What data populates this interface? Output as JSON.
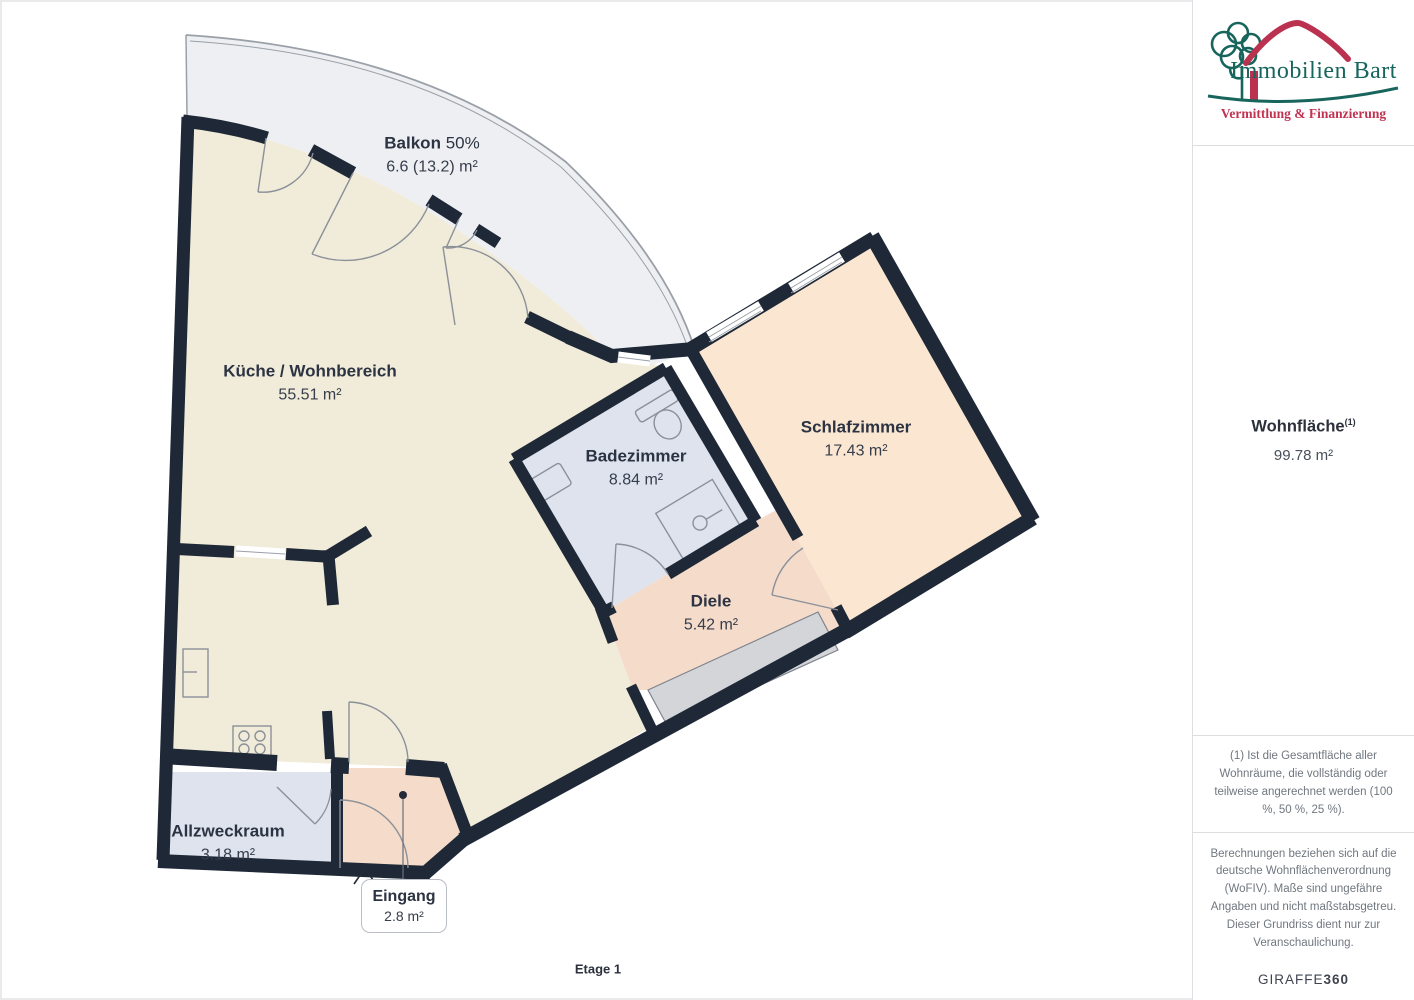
{
  "plan": {
    "floor_label": "Etage 1",
    "rooms": [
      {
        "id": "balkon",
        "name": "Balkon",
        "name_suffix": "50%",
        "area": "6.6 (13.2) m²"
      },
      {
        "id": "kueche",
        "name": "Küche / Wohnbereich",
        "area": "55.51 m²"
      },
      {
        "id": "badezimmer",
        "name": "Badezimmer",
        "area": "8.84 m²"
      },
      {
        "id": "schlafzimmer",
        "name": "Schlafzimmer",
        "area": "17.43 m²"
      },
      {
        "id": "diele",
        "name": "Diele",
        "area": "5.42 m²"
      },
      {
        "id": "allzweckraum",
        "name": "Allzweckraum",
        "area": "3.18 m²"
      },
      {
        "id": "eingang",
        "name": "Eingang",
        "area": "2.8 m²"
      }
    ],
    "colors": {
      "wall": "#1e2836",
      "kueche": "#f1ecd9",
      "balkon": "#edeff3",
      "badezimmer": "#dee3ee",
      "schlafzimmer": "#fbe7d1",
      "diele": "#f4dbca",
      "eingang": "#f4dbca",
      "allzweckraum": "#dee3ee",
      "schrank": "#d4d5d8"
    }
  },
  "sidebar": {
    "logo": {
      "title": "Immobilien Bart",
      "subtitle": "Vermittlung & Finanzierung",
      "teal": "#17655c",
      "red": "#bb3150"
    },
    "wohnflaeche": {
      "label": "Wohnfläche",
      "superscript": "(1)",
      "value": "99.78 m²"
    },
    "footnote1": "(1) Ist die Gesamtfläche aller Wohnräume, die vollständig oder teilweise angerechnet werden (100 %, 50 %, 25 %).",
    "footnote2": "Berechnungen beziehen sich auf die deutsche Wohnflächenverordnung (WoFIV). Maße sind ungefähre Angaben und nicht maßstabsgetreu. Dieser Grundriss dient nur zur Veranschaulichung.",
    "brand": {
      "name": "GIRAFFE",
      "suffix": "360"
    }
  }
}
